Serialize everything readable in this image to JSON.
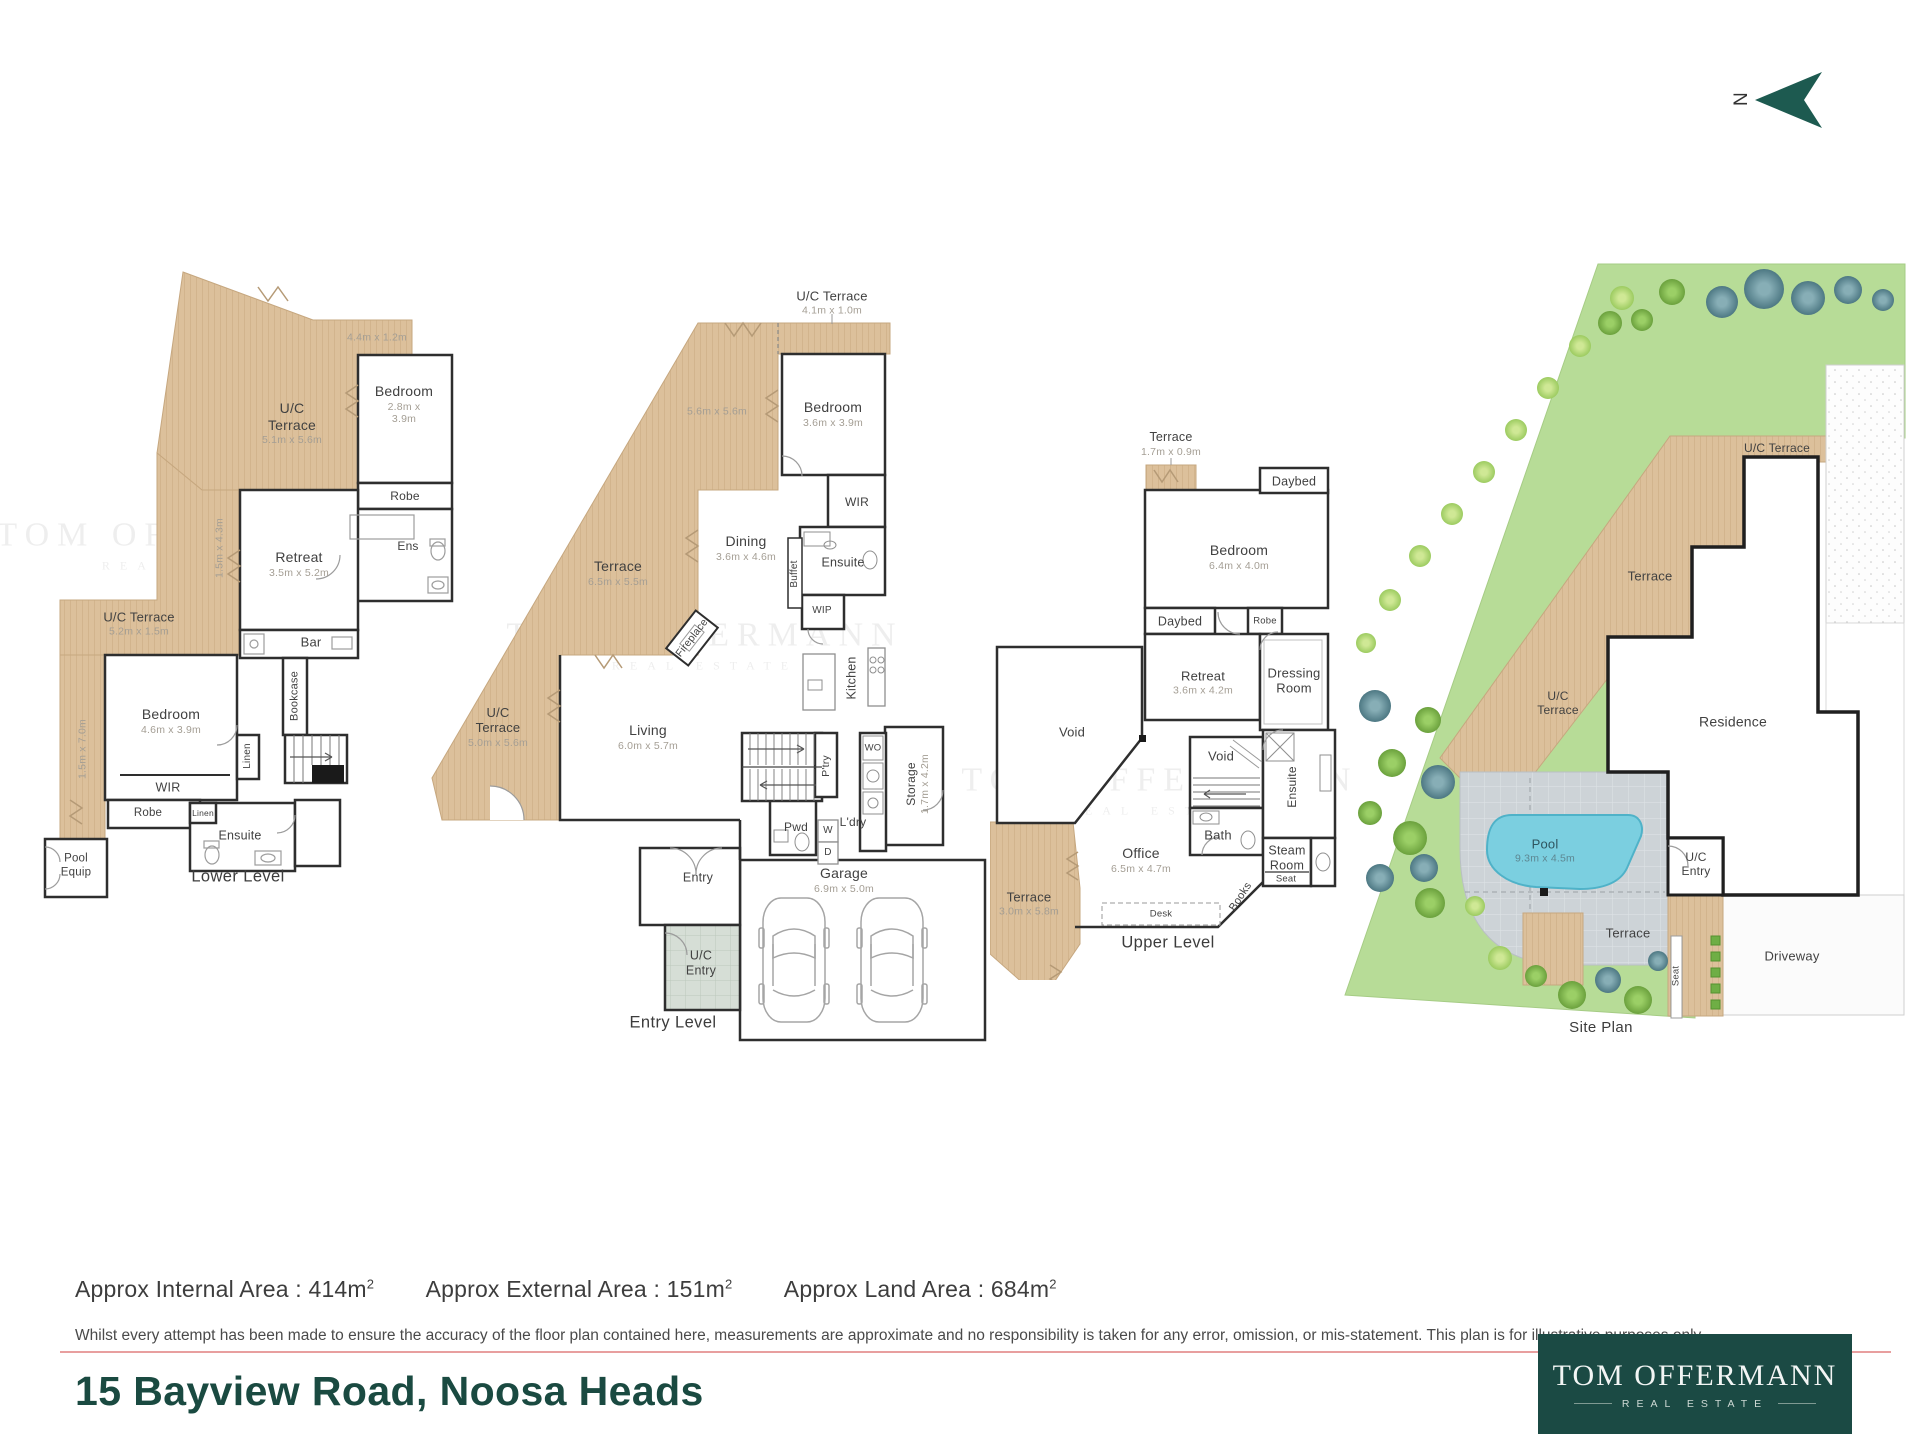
{
  "north": {
    "label": "N"
  },
  "watermark": {
    "line1": "TOM OFFERMANN",
    "line2": "REAL ESTATE"
  },
  "plans": {
    "lower": {
      "title": "Lower Level",
      "dimTop": "4.4m x 1.2m",
      "ucTerraceTop": {
        "name": "U/C\nTerrace",
        "dim": "5.1m x 5.6m"
      },
      "bedroom1": {
        "name": "Bedroom",
        "dim": "2.8m x 3.9m"
      },
      "robe1": "Robe",
      "ens": "Ens",
      "retreat": {
        "name": "Retreat",
        "dim": "3.5m x 5.2m"
      },
      "bar": "Bar",
      "bookcase": "Bookcase",
      "dimSide": "1.5m x 4.3m",
      "ucTerraceLeft": {
        "name": "U/C Terrace",
        "dim": "5.2m x 1.5m"
      },
      "dimLeft": "1.5m x 7.0m",
      "bedroom2": {
        "name": "Bedroom",
        "dim": "4.6m x 3.9m"
      },
      "wir": "WIR",
      "linenTall": "Linen",
      "robe2": "Robe",
      "linenSmall": "Linen",
      "ensuite": "Ensuite",
      "poolEquip": "Pool\nEquip"
    },
    "entry": {
      "title": "Entry Level",
      "ucTerraceTop": {
        "name": "U/C Terrace",
        "dim": "4.1m x 1.0m"
      },
      "dimMid": "5.6m x 5.6m",
      "bedroom": {
        "name": "Bedroom",
        "dim": "3.6m x 3.9m"
      },
      "wir": "WIR",
      "ensuite": "Ensuite",
      "buffet": "Buffet",
      "wip": "WIP",
      "dining": {
        "name": "Dining",
        "dim": "3.6m x 4.6m"
      },
      "terrace": {
        "name": "Terrace",
        "dim": "6.5m x 5.5m"
      },
      "fireplace": "Fireplace",
      "kitchen": "Kitchen",
      "ucTerraceLeft": {
        "name": "U/C\nTerrace",
        "dim": "5.0m x 5.6m"
      },
      "living": {
        "name": "Living",
        "dim": "6.0m x 5.7m"
      },
      "ptry": "P'try",
      "wo": "WO",
      "storage": {
        "name": "Storage",
        "dim": "1.7m x 4.2m"
      },
      "pwd": "Pwd",
      "w": "W",
      "d": "D",
      "ldry": "L'dry",
      "garage": {
        "name": "Garage",
        "dim": "6.9m x 5.0m"
      },
      "entry": "Entry",
      "ucEntry": "U/C\nEntry"
    },
    "upper": {
      "title": "Upper Level",
      "terraceTop": {
        "name": "Terrace",
        "dim": "1.7m x 0.9m"
      },
      "daybed1": "Daybed",
      "bedroom": {
        "name": "Bedroom",
        "dim": "6.4m x 4.0m"
      },
      "daybed2": "Daybed",
      "robe": "Robe",
      "retreat": {
        "name": "Retreat",
        "dim": "3.6m x 4.2m"
      },
      "dressing": "Dressing\nRoom",
      "void1": "Void",
      "void2": "Void",
      "ensuite": "Ensuite",
      "bath": "Bath",
      "steam": "Steam\nRoom",
      "seat": "Seat",
      "office": {
        "name": "Office",
        "dim": "6.5m x 4.7m"
      },
      "terraceLeft": {
        "name": "Terrace",
        "dim": "3.0m x 5.8m"
      },
      "books": "Books",
      "desk": "Desk"
    },
    "site": {
      "title": "Site Plan",
      "ucTerraceTop": "U/C Terrace",
      "terrace1": "Terrace",
      "residence": "Residence",
      "ucTerrace2": "U/C\nTerrace",
      "pool": {
        "name": "Pool",
        "dim": "9.3m x 4.5m"
      },
      "ucEntry": "U/C\nEntry",
      "terrace2": "Terrace",
      "seat": "Seat",
      "driveway": "Driveway"
    }
  },
  "footer": {
    "areas": [
      {
        "label": "Approx Internal Area : 414m",
        "sup": "2"
      },
      {
        "label": "Approx External Area : 151m",
        "sup": "2"
      },
      {
        "label": "Approx Land Area : 684m",
        "sup": "2"
      }
    ],
    "disclaimer": "Whilst every attempt has been made to ensure the accuracy of the floor plan contained here, measurements are approximate and no responsibility is taken for any error, omission, or mis-statement. This plan is for illustrative purposes only.",
    "address": "15 Bayview Road, Noosa Heads"
  },
  "brand": {
    "name": "TOM OFFERMANN",
    "tagline": "REAL ESTATE"
  }
}
